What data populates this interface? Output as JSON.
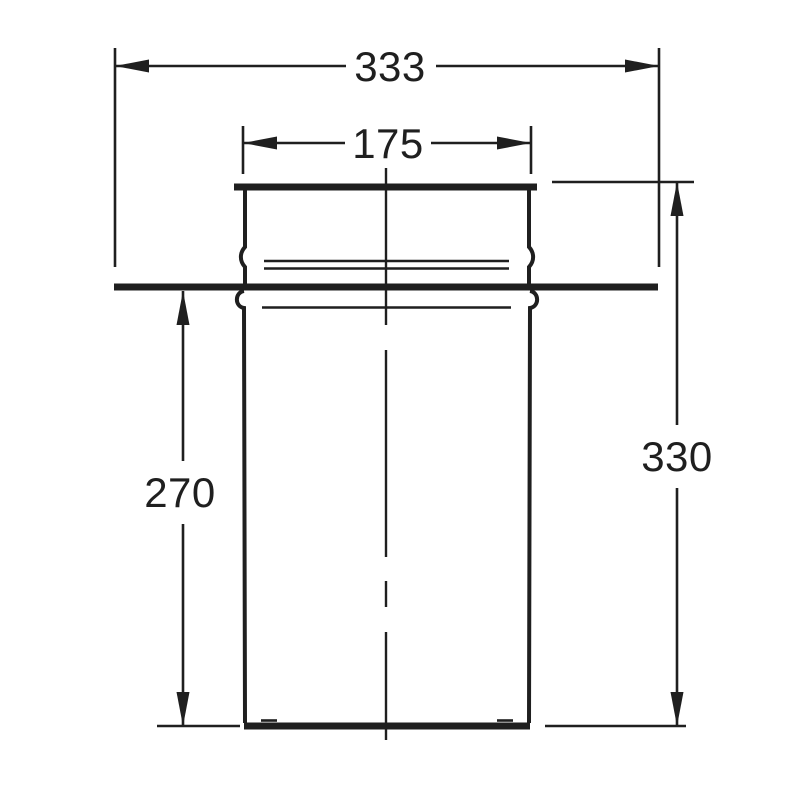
{
  "drawing": {
    "background_color": "#ffffff",
    "stroke_color": "#1f1f1f",
    "dimensions": {
      "flange_width": "333",
      "socket_diameter": "175",
      "pipe_below_flange": "270",
      "overall_height": "330"
    }
  }
}
